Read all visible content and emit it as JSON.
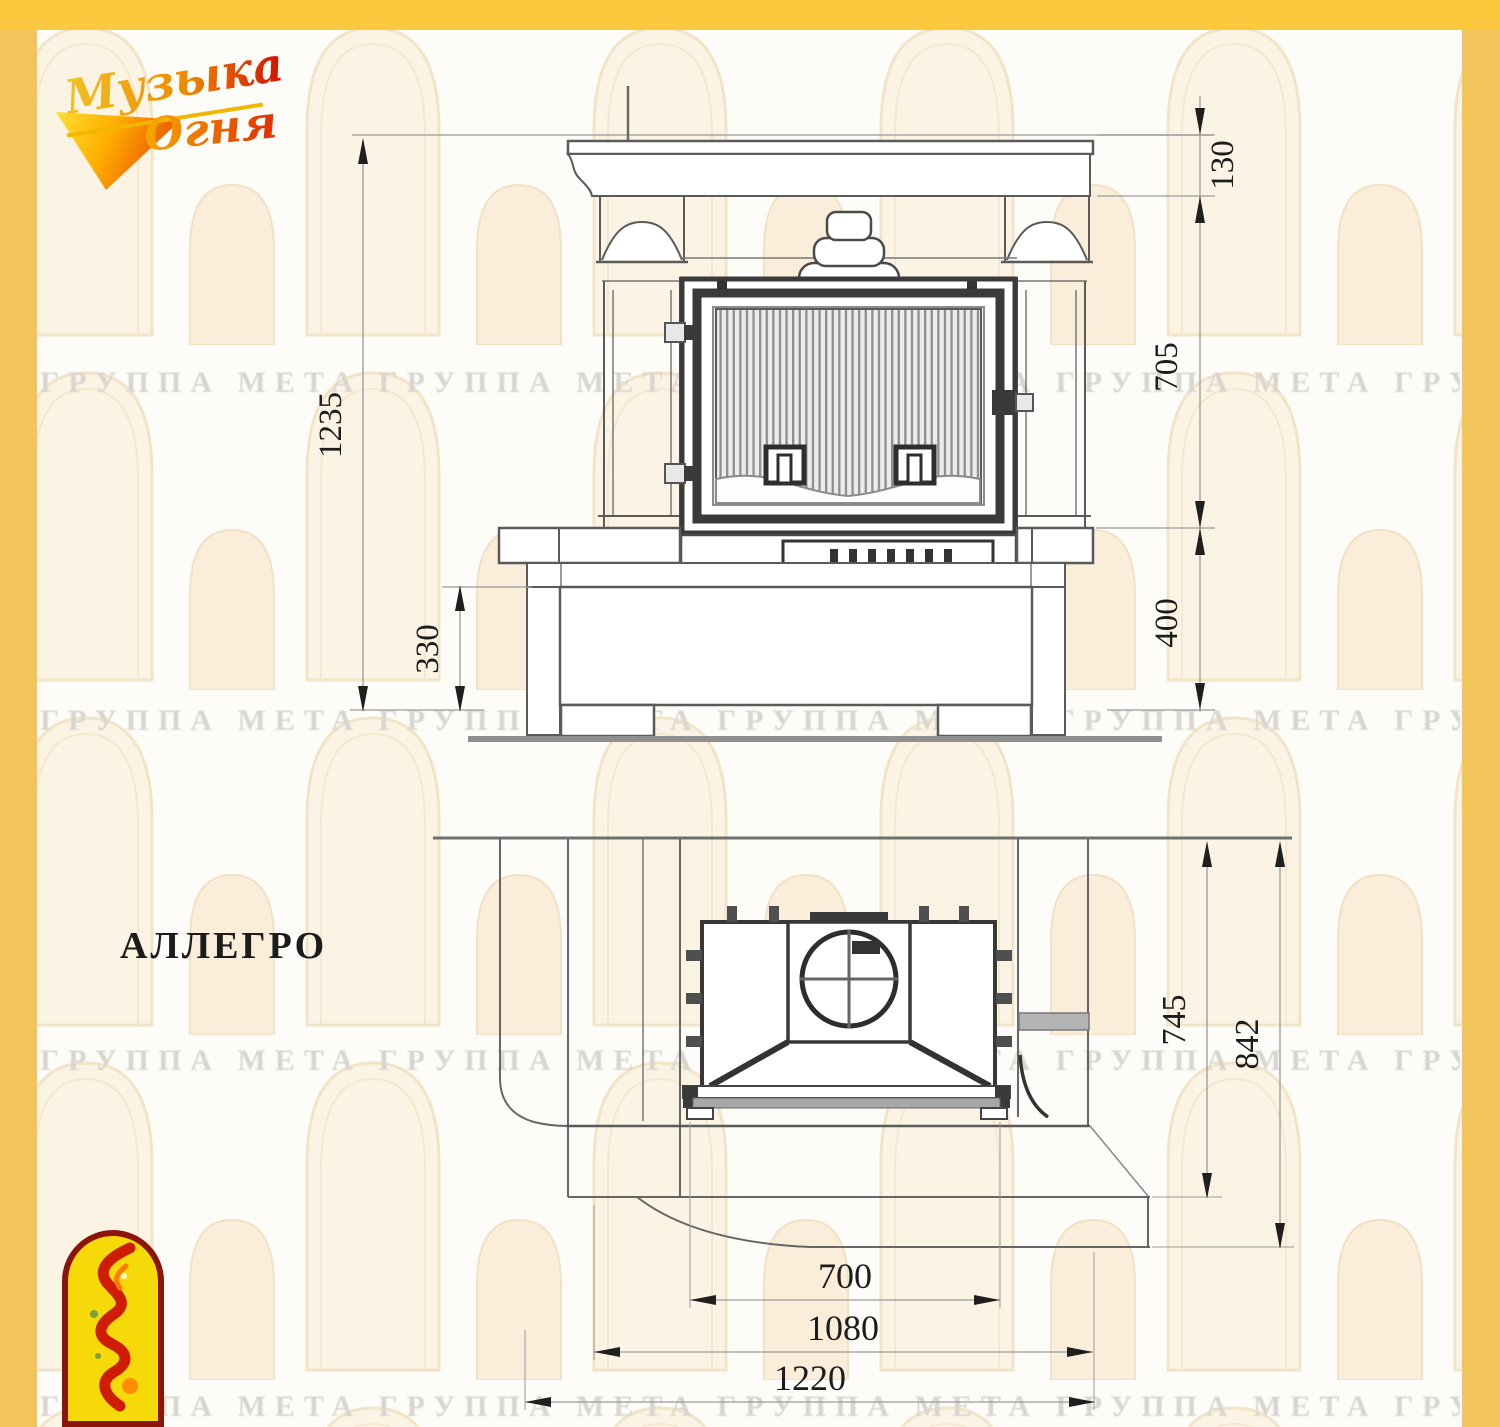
{
  "page_title": "АЛЛЕГРО",
  "brand_logo": {
    "line1": "Музыка",
    "line2": "Огня"
  },
  "watermark": {
    "phrase": "ГРУППА МЕТА",
    "row_text": "ГРУППА МЕТА   ГРУППА МЕТА   ГРУППА МЕТА   ГРУППА МЕТА   ГРУППА МЕТА   ГРУППА МЕТА"
  },
  "front_view": {
    "dim_total_height": "1235",
    "dim_plinth_front_height": "330",
    "dim_mantel_shelf_height": "130",
    "dim_firebox_zone_height": "705",
    "dim_base_height": "400"
  },
  "plan_view": {
    "dim_mantel_depth": "745",
    "dim_total_depth": "842",
    "dim_firebox_front_width": "700",
    "dim_portal_width": "1080",
    "dim_total_width": "1220"
  },
  "colors": {
    "frame_top": "#fcc83d",
    "frame_side": "#f2c55c",
    "line_dark": "#383838",
    "line_mid": "#5a5a5a",
    "dim_line": "#9a9a9a",
    "dim_text": "#1c1c1c",
    "badge_yellow": "#f6d908",
    "badge_border_red": "#8c150b",
    "flame_red": "#cf1d05"
  }
}
